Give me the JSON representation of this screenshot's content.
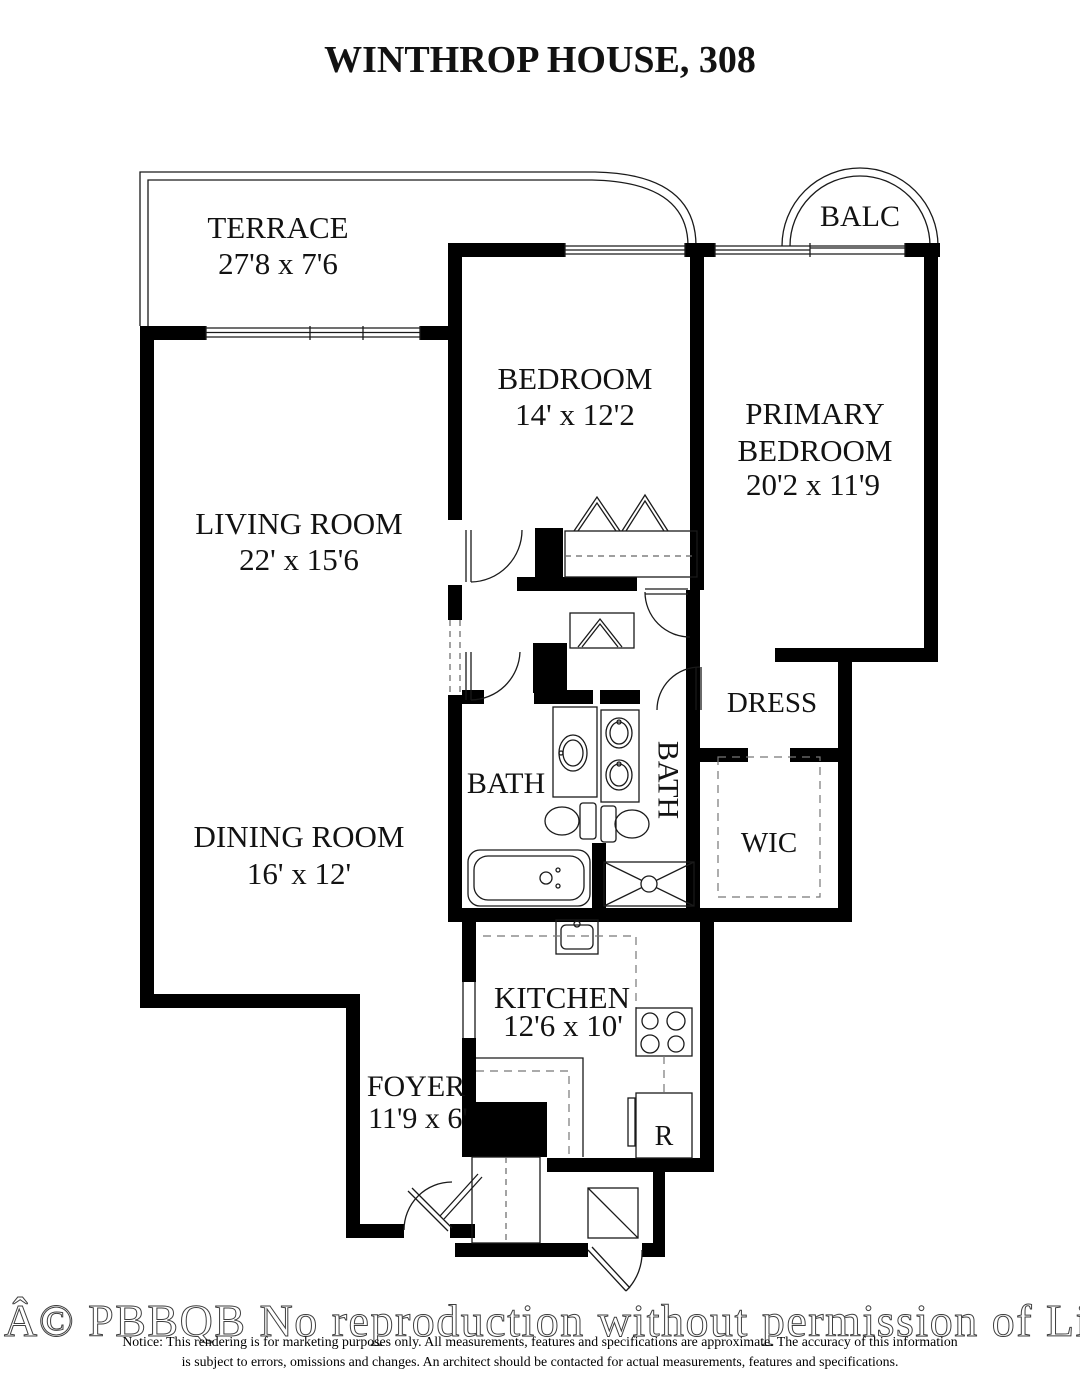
{
  "title": "WINTHROP HOUSE, 308",
  "rooms": {
    "terrace": {
      "name": "TERRACE",
      "dims": "27'8 x 7'6"
    },
    "balcony": {
      "name": "BALC"
    },
    "bedroom": {
      "name": "BEDROOM",
      "dims": "14' x 12'2"
    },
    "primary_bedroom": {
      "name_line1": "PRIMARY",
      "name_line2": "BEDROOM",
      "dims": "20'2 x 11'9"
    },
    "living_room": {
      "name": "LIVING ROOM",
      "dims": "22' x 15'6"
    },
    "dining_room": {
      "name": "DINING ROOM",
      "dims": "16' x 12'"
    },
    "kitchen": {
      "name": "KITCHEN",
      "dims": "12'6 x 10'"
    },
    "foyer": {
      "name": "FOYER",
      "dims": "11'9 x 6'"
    },
    "bath_hall": {
      "name": "BATH"
    },
    "bath_primary": {
      "name": "BATH"
    },
    "dressing": {
      "name": "DRESS"
    },
    "walk_in_closet": {
      "name": "WIC"
    },
    "refrigerator": {
      "label": "R"
    }
  },
  "watermark": "Â© PBBQB No reproduction without permission of Listing Brok",
  "disclaimer_line1": "Notice: This rendering is for marketing purposes only. All measurements, features and specifications are approximate. The accuracy of this information",
  "disclaimer_line2": "is subject to errors, omissions and changes. An architect should be contacted for actual measurements, features and specifications.",
  "colors": {
    "walls": "#000000",
    "background": "#ffffff",
    "watermark_outline": "#3f3f3f"
  }
}
